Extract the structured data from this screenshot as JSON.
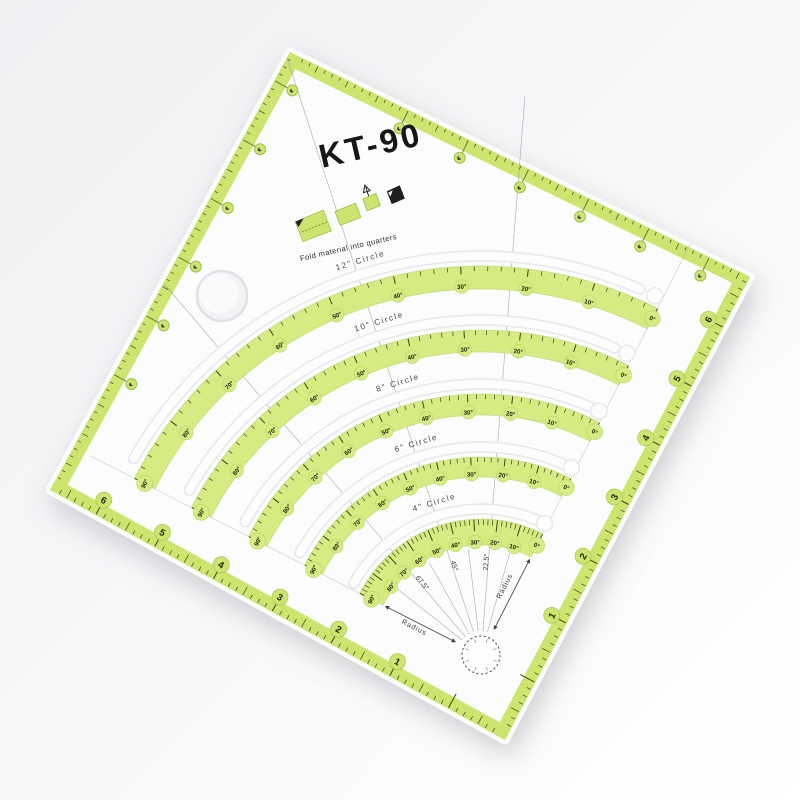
{
  "product": {
    "code": "KT-90",
    "fold_instruction": "Fold material into quarters"
  },
  "arcs": {
    "circles": [
      {
        "label": "12\" Circle"
      },
      {
        "label": "10\" Circle"
      },
      {
        "label": "8\" Circle"
      },
      {
        "label": "6\" Circle"
      },
      {
        "label": "4\" Circle"
      }
    ],
    "degree_labels": [
      "0°",
      "10°",
      "20°",
      "30°",
      "40°",
      "50°",
      "60°",
      "70°",
      "80°",
      "90°"
    ],
    "angle_line_labels": [
      "22.5°",
      "45°",
      "67.5°"
    ],
    "radius_label": "Radius"
  },
  "edges": {
    "bottom_right_numbers": [
      "1",
      "2",
      "3",
      "4",
      "5",
      "6"
    ],
    "bottom_left_numbers": [
      "1",
      "2",
      "3",
      "4",
      "5",
      "6"
    ]
  },
  "colors": {
    "band_green": "#d6eb82",
    "edge_green": "#cde46f",
    "band_stroke": "#aecb54",
    "tick": "#3c441a",
    "number": "#23260f",
    "text_dark": "#1c1c1c",
    "line_gray": "#9b9ba3",
    "slot_outline": "#e7e7ec",
    "slot_fill": "#fdfdfe",
    "ruler_fill": "#fcfcfd"
  }
}
